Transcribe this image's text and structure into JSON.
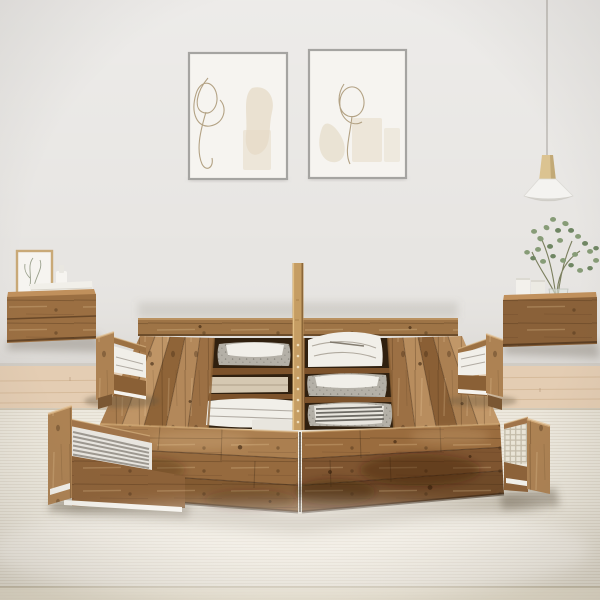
{
  "scene": {
    "type": "furniture-product-photo",
    "description": "Rustic reclaimed-wood platform storage bed with open top compartments holding folded white linens and grey fabric baskets, four pulled-out storage drawers with folded textiles, a tall centre wood post, two floating wood nightstands with decor, two framed abstract line-art posters and a white pendant lamp against a light grey wall over a pale wood floor and cream rug",
    "objects": [
      {
        "name": "wall",
        "label": "plain light grey wall"
      },
      {
        "name": "wood-floor",
        "label": "pale oak plank floor strip"
      },
      {
        "name": "rug",
        "label": "large cream woven rug with seam near bottom"
      },
      {
        "name": "wall-art-left",
        "label": "framed abstract one-line drawing with beige shapes"
      },
      {
        "name": "wall-art-right",
        "label": "framed abstract one-line drawing with beige shapes"
      },
      {
        "name": "pendant-lamp",
        "label": "white cone pendant lamp with wood top on thin cord"
      },
      {
        "name": "nightstand-left",
        "label": "floating rustic wood nightstand with small framed print, white vessel and white book stack"
      },
      {
        "name": "nightstand-right",
        "label": "floating rustic wood nightstand with two white books and eucalyptus plant in glass vase"
      },
      {
        "name": "storage-bed",
        "label": "reclaimed-wood storage bed frame, two halves with open linen compartments and centre post"
      },
      {
        "name": "drawer-mid-left",
        "label": "pulled-out drawer with folded white linen"
      },
      {
        "name": "drawer-front-left",
        "label": "pulled-out drawer with grey striped linen"
      },
      {
        "name": "drawer-mid-right",
        "label": "pulled-out drawer with folded white linen"
      },
      {
        "name": "drawer-front-right",
        "label": "pulled-out drawer with beige checked linen"
      }
    ]
  },
  "palette": {
    "wall": "#e7e5e2",
    "wall_shade": "#d7d4cf",
    "baseboard": "#c9c2b8",
    "floor_wood": "#e4cdb3",
    "floor_plank_line": "#d2b493",
    "rug": "#e9e4d8",
    "rug_seam": "#b4a98f",
    "rug_below": "#e2dbc8",
    "wood_rail": "#9e7446",
    "wood_top": "#a87c4e",
    "wood_front_left": "#9b6f42",
    "wood_front_right": "#8a6139",
    "wood_dark": "#5c3c20",
    "wood_post": "#c59d63",
    "drawer_wood": "#a87c4e",
    "drawer_panel": "#ad8253",
    "compartment_dark": "#30200f",
    "textile_white": "#f1efe9",
    "textile_fold": "#968f83",
    "basket_gray": "#b4b0a7",
    "stripe_gray": "#8f8b82",
    "check_beige": "#e9e4d6",
    "frame_gray": "#a5a4a1",
    "art_bg": "#f6f4f0",
    "art_line": "#b3a284",
    "art_blob": "#e5dbc7",
    "small_frame_wood": "#c9a977",
    "plant_green": "#879c77",
    "plant_green_dark": "#6f8663",
    "stem_green": "#7b7f5e",
    "lamp_shade": "#f4f3f0",
    "lamp_wood": "#dbc391",
    "cord": "#b5b1ab",
    "shadow": "#8d8578"
  }
}
